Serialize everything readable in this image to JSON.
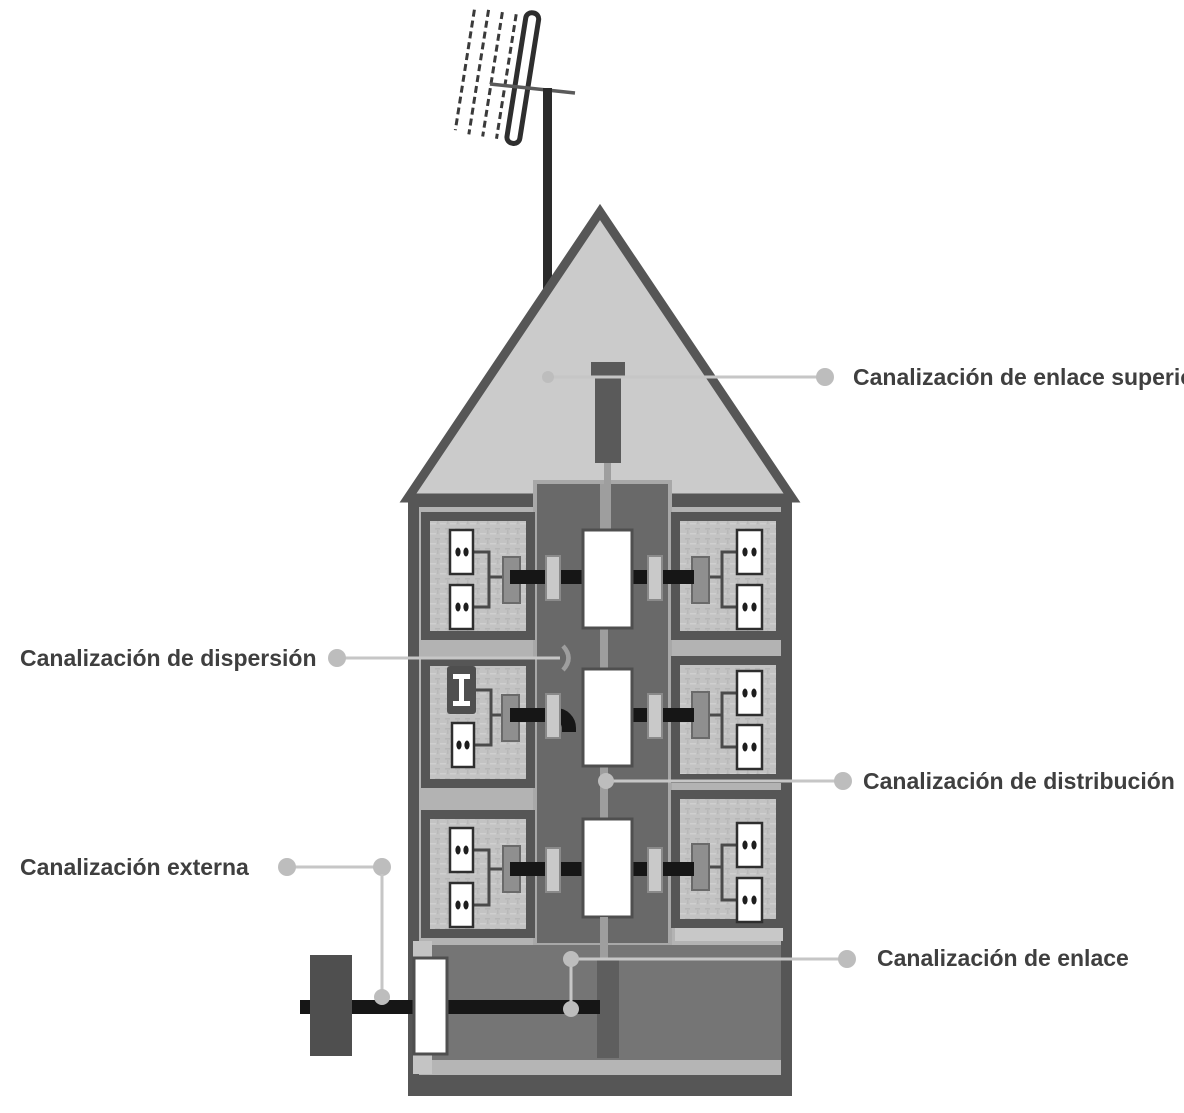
{
  "figure": {
    "description": "Cross-section diagram of a building showing the common telecommunications infrastructure (ICT) canalizations, with a rooftop antenna, a central riser shaft, three floors of dwellings with sockets, a basement entry and an external network connection.",
    "labels": {
      "enlace_superior": "Canalización de enlace superior",
      "dispersion": "Canalización de dispersión",
      "distribucion": "Canalización de distribución",
      "externa": "Canalización externa",
      "enlace": "Canalización de enlace"
    },
    "icons": [
      "antenna-icon",
      "mast-icon",
      "roof-icon",
      "riser-shaft-icon",
      "registry-box-icon",
      "pass-register-icon",
      "pau-register-icon",
      "socket-outlet-icon",
      "tv-terminal-icon",
      "basement-icon",
      "external-network-icon",
      "leader-dot-icon"
    ],
    "colors": {
      "ink": "#161616",
      "wall_dark": "#565656",
      "roof_fill": "#cbcbcb",
      "shaft_fill": "#696969",
      "interior_light": "#b3b3b3",
      "apartment_inner": "#c3c3c3",
      "basement_fill": "#757575",
      "leader_gray": "#c6c6c6",
      "label_text": "#3f3f3f",
      "white": "#ffffff"
    },
    "counts": {
      "floors": 3,
      "dwellings": 6,
      "socket_outlets_per_dwelling": 2,
      "registry_boxes_in_shaft": 3
    }
  }
}
